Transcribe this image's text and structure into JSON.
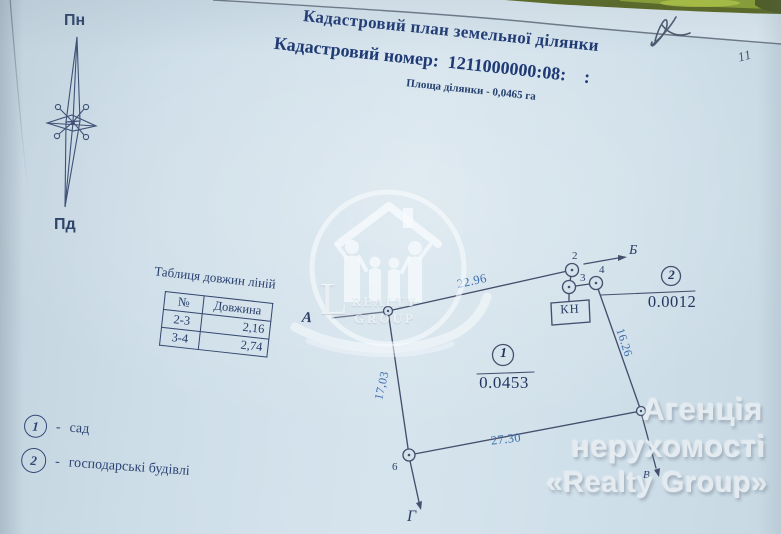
{
  "header": {
    "title": "Кадастровий план земельної ділянки",
    "cadastral_number": "Кадастровий номер:  1211000000:08:    :",
    "area": "Площа ділянки - 0,0465 га"
  },
  "compass": {
    "north": "Пн",
    "south": "Пд"
  },
  "lengths_table": {
    "title": "Таблиця довжин ліній",
    "headers": {
      "no": "№",
      "length": "Довжина"
    },
    "rows": [
      {
        "no": "2-3",
        "length": "2,16"
      },
      {
        "no": "3-4",
        "length": "2,74"
      }
    ]
  },
  "plot": {
    "direction_a": "А",
    "direction_b": "Б",
    "direction_v": "В",
    "direction_g": "Г",
    "point_2": "2",
    "point_3": "3",
    "point_4": "4",
    "point_6": "6",
    "length_top": "22.96",
    "length_right": "16.26",
    "length_bottom": "27.30",
    "length_left": "17,03",
    "section1_number": "1",
    "section1_area": "0.0453",
    "section2_number": "2",
    "section2_area": "0.0012",
    "kn_label": "КН"
  },
  "legend": {
    "dash": "-",
    "items": [
      {
        "number": "1",
        "label": "сад"
      },
      {
        "number": "2",
        "label": "господарські будівлі"
      }
    ]
  },
  "watermark": {
    "logo_letter": "L",
    "logo_word1": "REALTY",
    "logo_word2": "GROUP",
    "line1": "Агенція",
    "line2": "нерухомості",
    "line3": "«Realty Group»"
  },
  "annotations": {
    "page_mark": "11"
  },
  "colors": {
    "paper": "#cfdfe9",
    "ink": "#1f3a74",
    "plot_line": "#454f6d",
    "measure_blue": "#3b6fae",
    "green_strip": "#57651e",
    "watermark": "#e6edf2"
  }
}
